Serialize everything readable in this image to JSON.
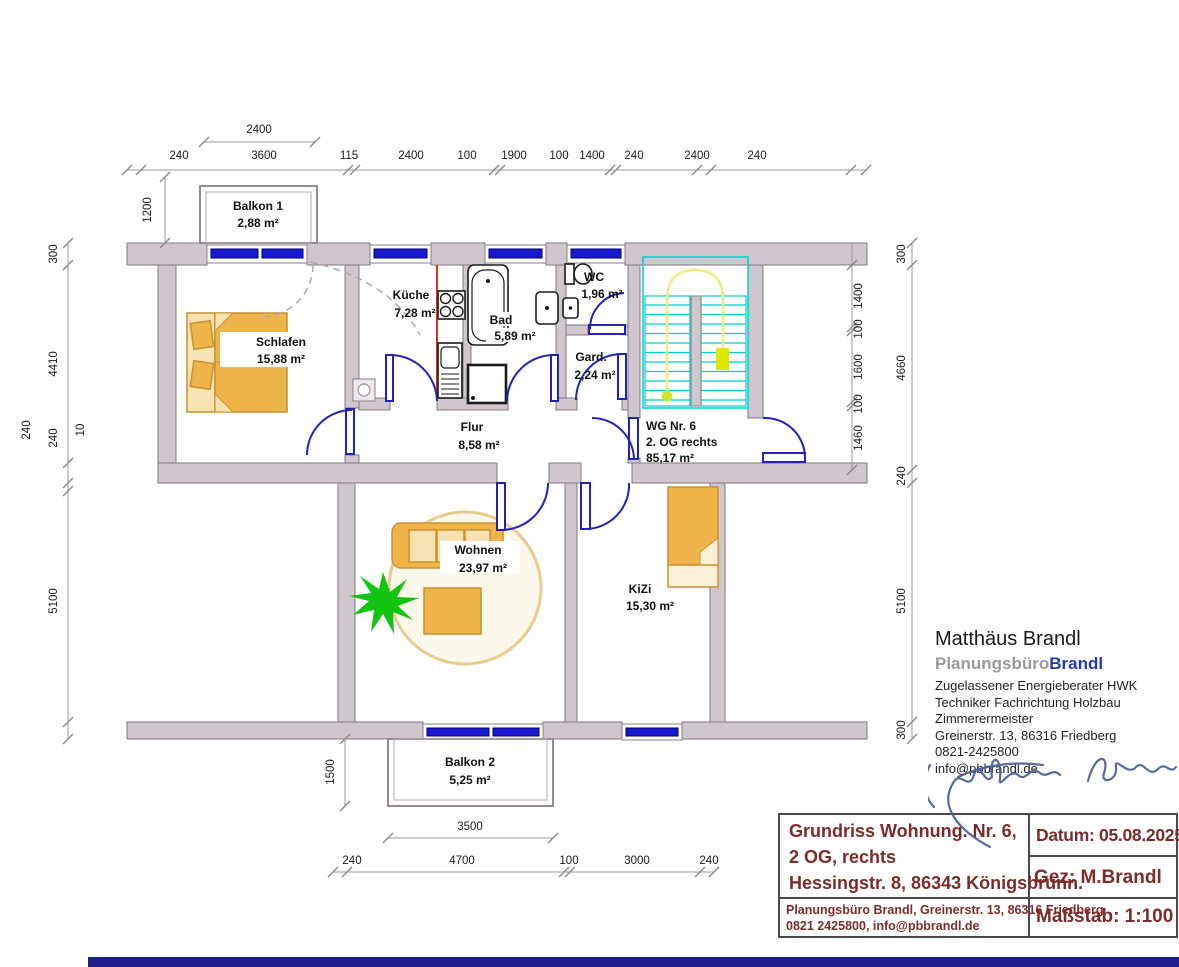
{
  "colors": {
    "wall": "#d0c6ce",
    "window_blue": "#1818cf",
    "door_blue": "#2222bb",
    "stairs_cyan": "#00cfcf",
    "path_yellow": "#ecec8a",
    "furniture_orange": "#f0b54a",
    "plant_green": "#12c412",
    "maroon": "#7c2b2b",
    "navy_bar": "#20208a",
    "red_line": "#e03020"
  },
  "plan": {
    "balkon1": {
      "name": "Balkon 1",
      "area": "2,88 m²"
    },
    "balkon2": {
      "name": "Balkon 2",
      "area": "5,25 m²"
    },
    "schlafen": {
      "name": "Schlafen",
      "area": "15,88 m²"
    },
    "kueche": {
      "name": "Küche",
      "area": "7,28 m²"
    },
    "bad": {
      "name": "Bad",
      "area": "5,89 m²"
    },
    "wc": {
      "name": "WC",
      "area": "1,96 m²"
    },
    "gard": {
      "name": "Gard.",
      "area": "2,24 m²"
    },
    "flur": {
      "name": "Flur",
      "area": "8,58 m²"
    },
    "wohnen": {
      "name": "Wohnen",
      "area": "23,97 m²"
    },
    "kizi": {
      "name": "KiZi",
      "area": "15,30 m²"
    },
    "apartment": {
      "line1": "WG Nr. 6",
      "line2": "2. OG rechts",
      "line3": "85,17 m²"
    }
  },
  "dimensions": {
    "top_overall": "2400",
    "top_chain": [
      "240",
      "3600",
      "115",
      "2400",
      "100",
      "1900",
      "100",
      "1400",
      "240",
      "2400",
      "240"
    ],
    "left_balcony": "1200",
    "left_outer": "240",
    "left_chain": [
      "300",
      "4410",
      "240",
      "10",
      "5100"
    ],
    "right_inner": [
      "1400",
      "100",
      "1600",
      "100",
      "1460"
    ],
    "right_outer": [
      "300",
      "4660",
      "240",
      "5100",
      "300"
    ],
    "balcony2_depth": "1500",
    "balcony2_width": "3500",
    "bottom_chain": [
      "240",
      "4700",
      "100",
      "3000",
      "240"
    ]
  },
  "contact": {
    "name": "Matthäus Brandl",
    "brand_gray": "Planungsbüro",
    "brand_blue": "Brandl",
    "role1": "Zugelassener Energieberater HWK",
    "role2": "Techniker Fachrichtung Holzbau",
    "role3": "Zimmerermeister",
    "address": "Greinerstr. 13, 86316 Friedberg",
    "phone": "0821-2425800",
    "email": "info@pbbrandl.de"
  },
  "titleblock": {
    "project_line1": "Grundriss Wohnung. Nr. 6,",
    "project_line2": "2 OG, rechts",
    "project_line3": "Hessingstr. 8, 86343 Königsbrunn.",
    "firm_line1": "Planungsbüro Brandl, Greinerstr. 13, 86316 Friedberg",
    "firm_line2": "0821 2425800, info@pbbrandl.de",
    "datum": "Datum: 05.08.2025",
    "gez": "Gez: M.Brandl",
    "massstab": "Maßstab: 1:100"
  }
}
